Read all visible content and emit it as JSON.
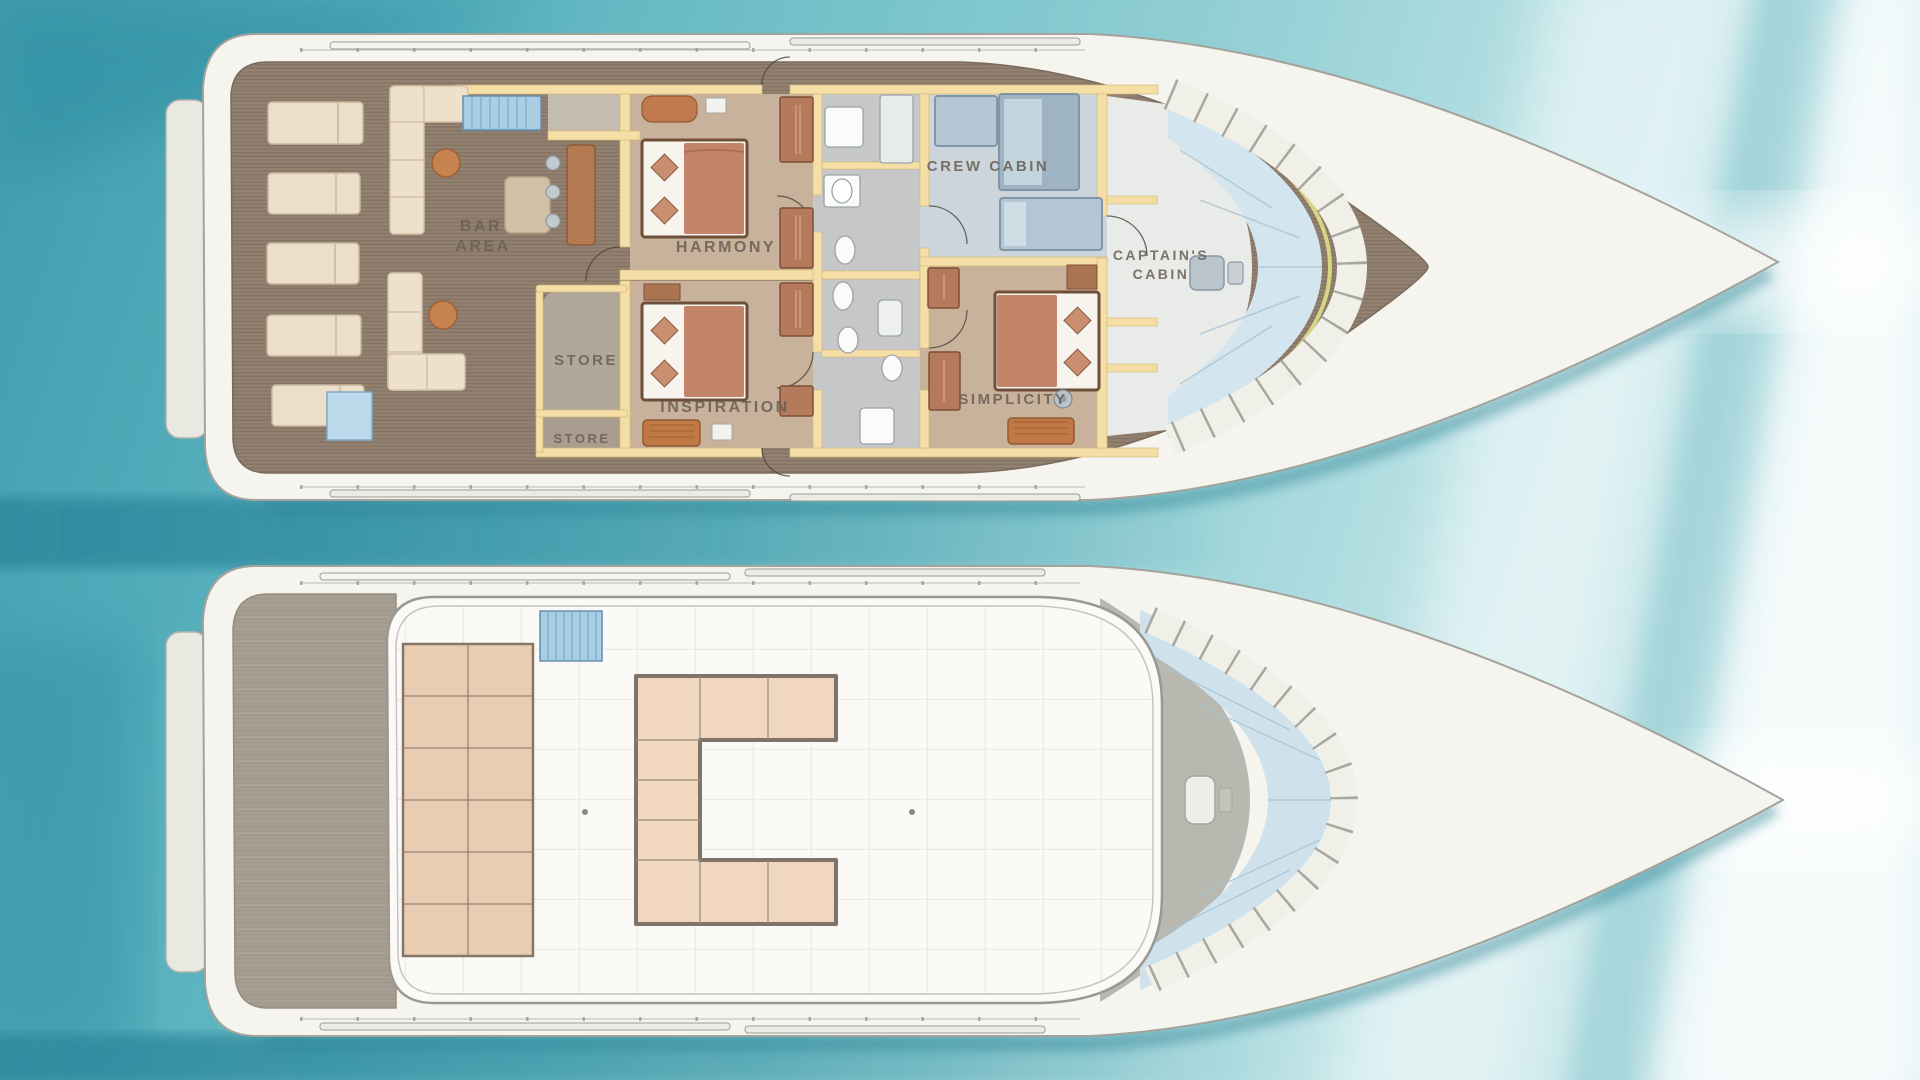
{
  "title": "Yacht deck plan illustration",
  "decks": {
    "main": {
      "name": "Main deck",
      "labels": {
        "bar_line1": "BAR",
        "bar_line2": "AREA",
        "store_upper": "STORE",
        "store_lower": "STORE",
        "harmony": "HARMONY",
        "inspiration": "INSPIRATION",
        "crew": "CREW CABIN",
        "captain_line1": "CAPTAIN'S",
        "captain_line2": "CABIN",
        "simplicity": "SIMPLICITY"
      }
    },
    "upper": {
      "name": "Upper sun deck",
      "labels": {}
    }
  },
  "palette": {
    "water_dark": "#3f9cad",
    "water_light": "#d5ecee",
    "hull_white": "#f5f4ef",
    "wood_main": "#8f7d6d",
    "wood_aft_upper_deck": "#a79e92",
    "wall_yellow": "#f5dfa6",
    "cabin_floor": "#c9b29b",
    "corridor_floor": "#c6c7c9",
    "crew_floor": "#ccd5db",
    "bed_blanket": "#c28569",
    "wardrobe": "#b5795c",
    "lounger": "#ecdfca",
    "table_wood": "#c6824f",
    "stairs_blue": "#a9cde3",
    "sunpad": "#e9ccb1",
    "glass": "#cfe2ec",
    "frame_yellow": "#d5d584"
  }
}
